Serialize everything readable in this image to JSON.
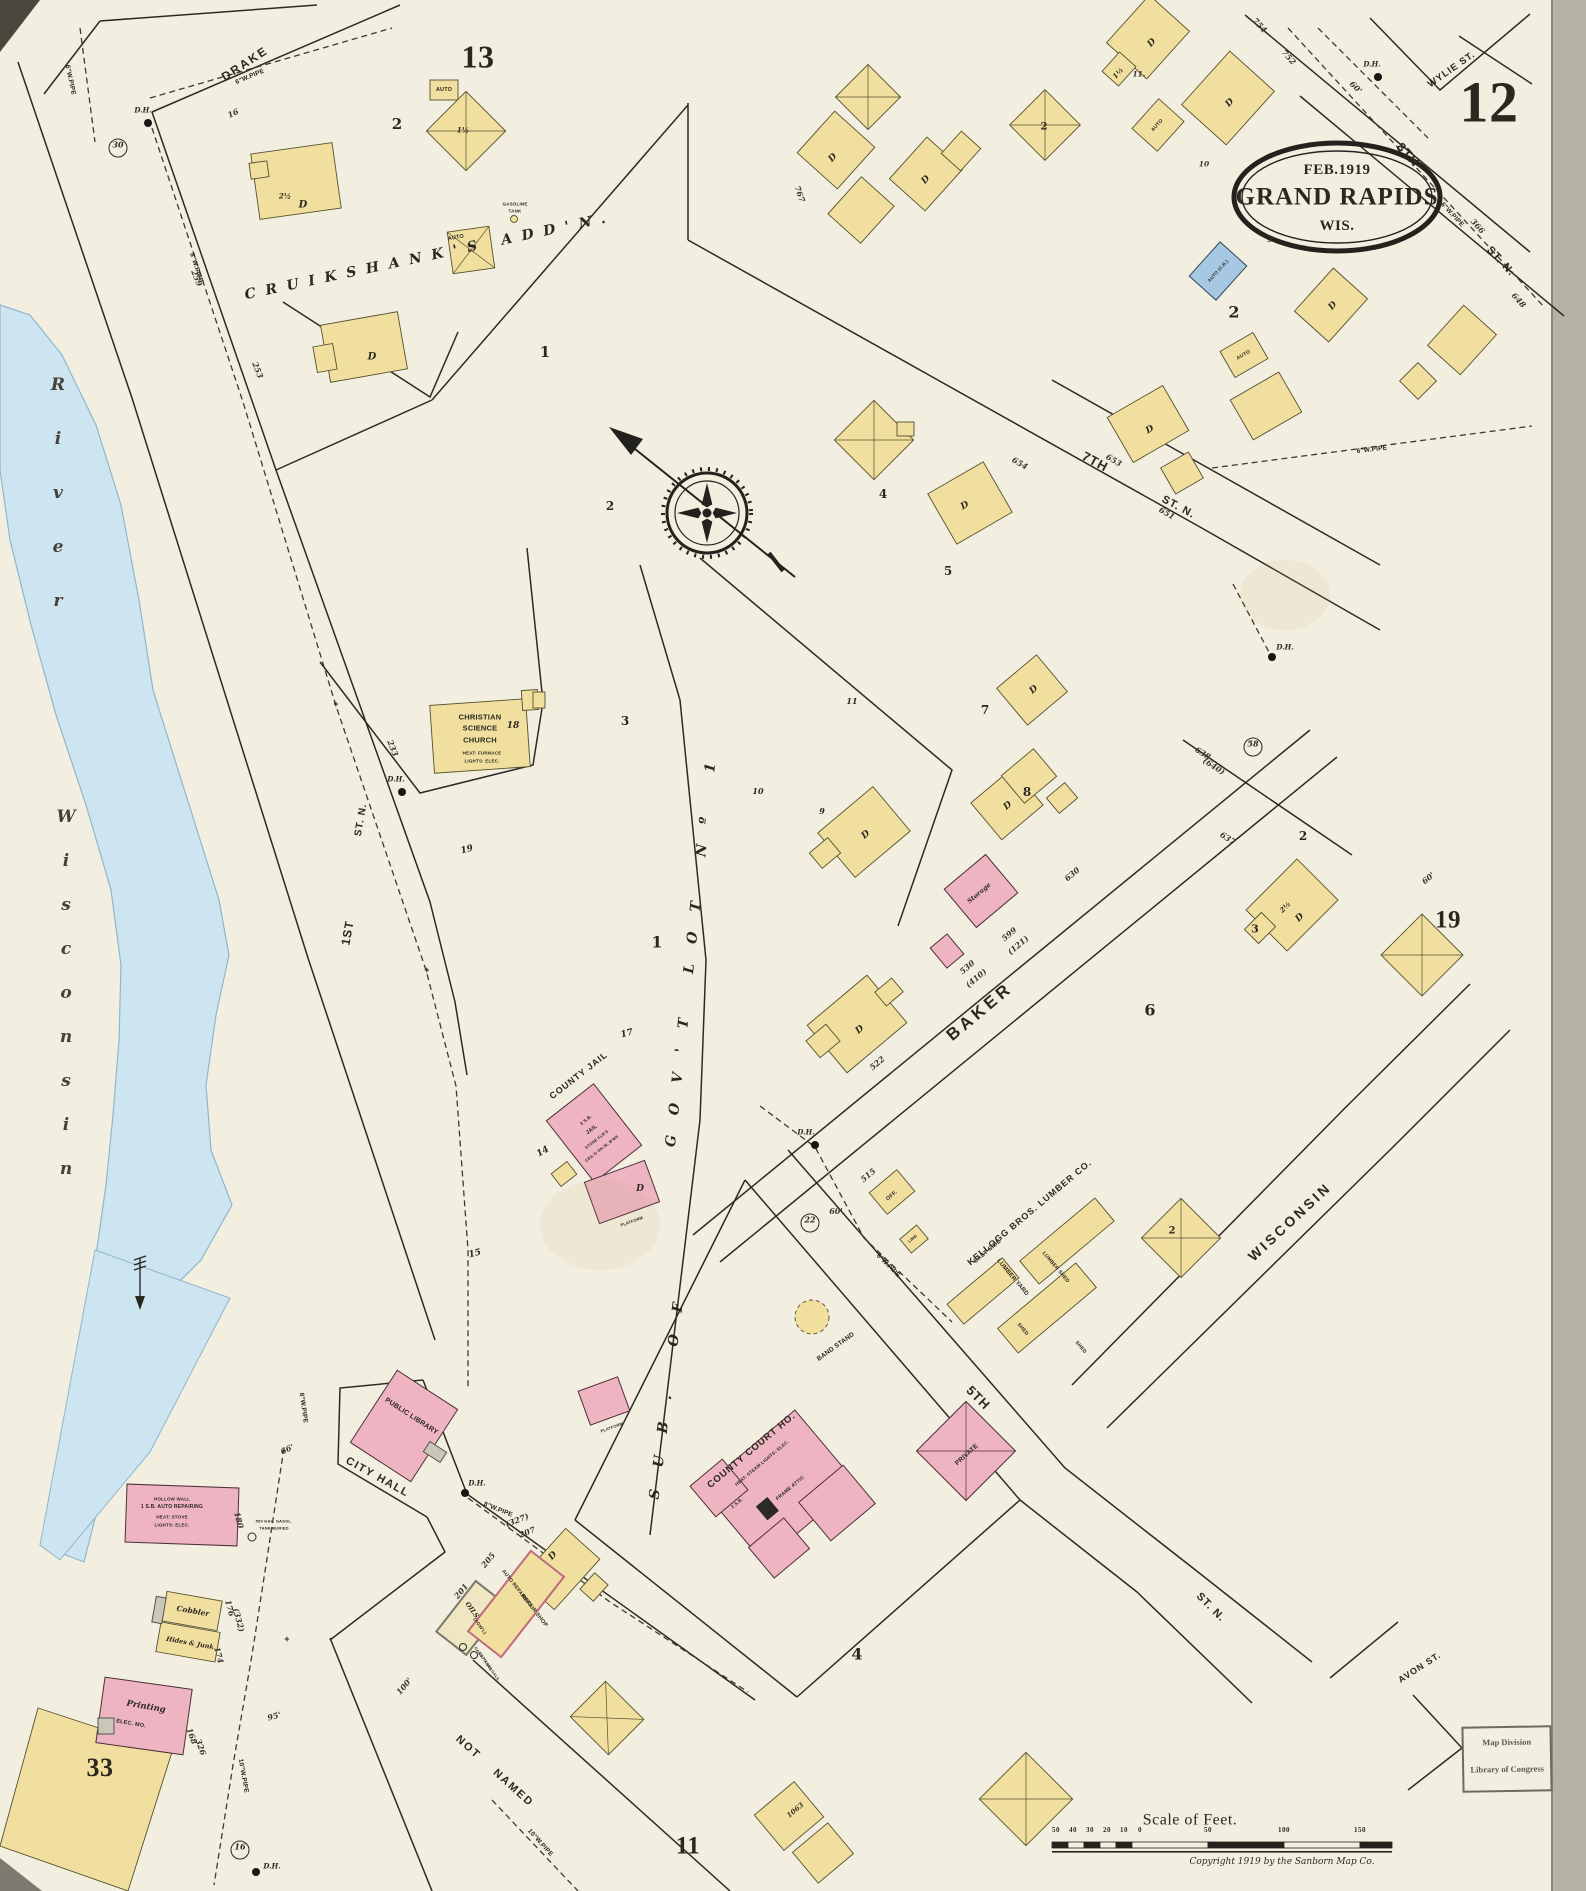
{
  "palette": {
    "paper": "#f3efe0",
    "ink": "#2b2820",
    "building_frame": "#f1df9f",
    "building_brick": "#eeb4c2",
    "building_stone": "#a6c8e3",
    "building_iron": "#c9c6ba",
    "river": "#cde4f1"
  },
  "title_oval": {
    "date": "FEB.1919",
    "city": "GRAND RAPIDS",
    "state": "WIS."
  },
  "sheet": {
    "number": "12",
    "neighbor_top_left": "13",
    "neighbor_right": "19",
    "neighbor_bottom": "11"
  },
  "streets": {
    "drake": "DRAKE",
    "wylie": "WYLIE ST.",
    "eighth": "8TH",
    "eighth_suffix": "ST. N.",
    "seventh": "7TH",
    "seventh_suffix": "ST. N.",
    "first": "1ST",
    "first_suffix": "ST. N.",
    "baker": "BAKER",
    "wisconsin": "WISCONSIN",
    "fifth": "5TH",
    "fifth_suffix": "ST. N.",
    "avon": "AVON ST.",
    "not_named": "NOT NAMED"
  },
  "districts": {
    "cruikshanks": "CRUIKSHANK'S ADD'N.",
    "sub_of": "SUB. OF",
    "govt_lot": "GOV'T LOT Nº 1",
    "river_word_upper": "River",
    "river_word_lower": "Wisconsin"
  },
  "landmarks": {
    "church": {
      "l1": "CHRISTIAN",
      "l2": "SCIENCE",
      "l3": "CHURCH",
      "note1": "HEAT: FURNACE",
      "note2": "LIGHTS: ELEC."
    },
    "jail": {
      "label": "COUNTY JAIL",
      "inner1": "3 S.B.",
      "inner2": "JAIL",
      "inner3": "STONE FLR'S",
      "inner4": "CEIL'G ON IR. B'MS"
    },
    "city_hall": {
      "label": "CITY HALL",
      "library": "PUBLIC LIBRARY"
    },
    "court_house": {
      "label": "COUNTY COURT HO.",
      "note": "HEAT: STEAM  LIGHTS: ELEC.",
      "attic": "FRAME ATTIC",
      "base": "2 S.B."
    },
    "band_stand": "BAND STAND",
    "private_hall": "PRIVATE",
    "kellogg": {
      "name": "KELLOGG BROS. LUMBER CO.",
      "sub": "EAST SIDE",
      "yard": "LUMBER YARD",
      "shed_long": "LUMBER SHED",
      "shed": "SHED",
      "office": "OFF.",
      "lime": "LIME"
    },
    "cobbler": "Cobbler",
    "hides_junk": "Hides & Junk",
    "printing": {
      "l1": "Printing",
      "l2": "ELEC. MO."
    },
    "river_garage": {
      "l1": "HOLLOW WALL",
      "l2": "1 S.B. AUTO REPAIRING",
      "l3": "HEAT: STOVE",
      "l4": "LIGHTS: ELEC."
    },
    "buried_tank": {
      "l1": "500 GAL. GASOL.",
      "l2": "TANK BURIED"
    },
    "oils": {
      "l1": "OILS",
      "l2": "(AGW'L)"
    },
    "repair_shop": {
      "l1": "AUTO REPAIRING",
      "l2": "REPAIR SHOP",
      "note1": "GASO. TANKS",
      "note2": "CAP'Y 550 GALS."
    },
    "storage": "Storage",
    "gasoline_tank": {
      "l1": "GASOLINE",
      "l2": "TANK"
    },
    "auto": "AUTO",
    "auto_cb": "AUTO (C.B.)",
    "dwelling": "D",
    "platform": "PLATFORM"
  },
  "markers": {
    "dh": "D.H.",
    "circle_30": "30",
    "circle_58": "58",
    "circle_22": "22",
    "circle_16": "16",
    "plus": "+"
  },
  "pipes": {
    "six": "6\"W.PIPE",
    "eight": "8\"W.PIPE",
    "ten": "10\"W.PIPE"
  },
  "dims": {
    "d16": "16",
    "d259": "259",
    "d253": "253",
    "d233": "233",
    "d767": "767",
    "d754": "754",
    "d752": "752",
    "d366": "366",
    "d648": "648",
    "d654": "654",
    "d653": "653",
    "d651": "651",
    "d638": "638",
    "d640": "(640)",
    "d637": "637",
    "d630": "630",
    "d599": "599",
    "d121": "(121)",
    "d530": "530",
    "d410": "(410)",
    "d522": "522",
    "d515": "515",
    "d180": "180",
    "d176": "176",
    "d332": "(332)",
    "d174": "174",
    "d168": "168",
    "d326": "326",
    "d205": "205",
    "d201": "201",
    "d207": "207",
    "d327": "(327)",
    "d1063": "1063",
    "d100": "100'",
    "d95": "95'",
    "d66": "66'",
    "d60": "60'",
    "d10": "10",
    "d11": "11."
  },
  "blocks": {
    "b1": "1",
    "b2": "2",
    "b3": "3",
    "b4": "4",
    "b5": "5",
    "b6": "6",
    "b7": "7",
    "b8": "8",
    "b9": "9",
    "b10": "10",
    "b11": "11",
    "b14": "14",
    "b15": "15",
    "b17": "17",
    "b18": "18",
    "b19": "19",
    "b33": "33",
    "b1h": "1½",
    "b2h": "2½"
  },
  "scale_bar": {
    "title": "Scale of Feet.",
    "ticks_left": [
      "50",
      "40",
      "30",
      "20",
      "10",
      "0"
    ],
    "ticks_right": [
      "50",
      "100",
      "150"
    ]
  },
  "copyright": "Copyright 1919 by the Sanborn Map Co.",
  "stamp": {
    "l1": "Map Division",
    "l2": "Library of Congress"
  }
}
